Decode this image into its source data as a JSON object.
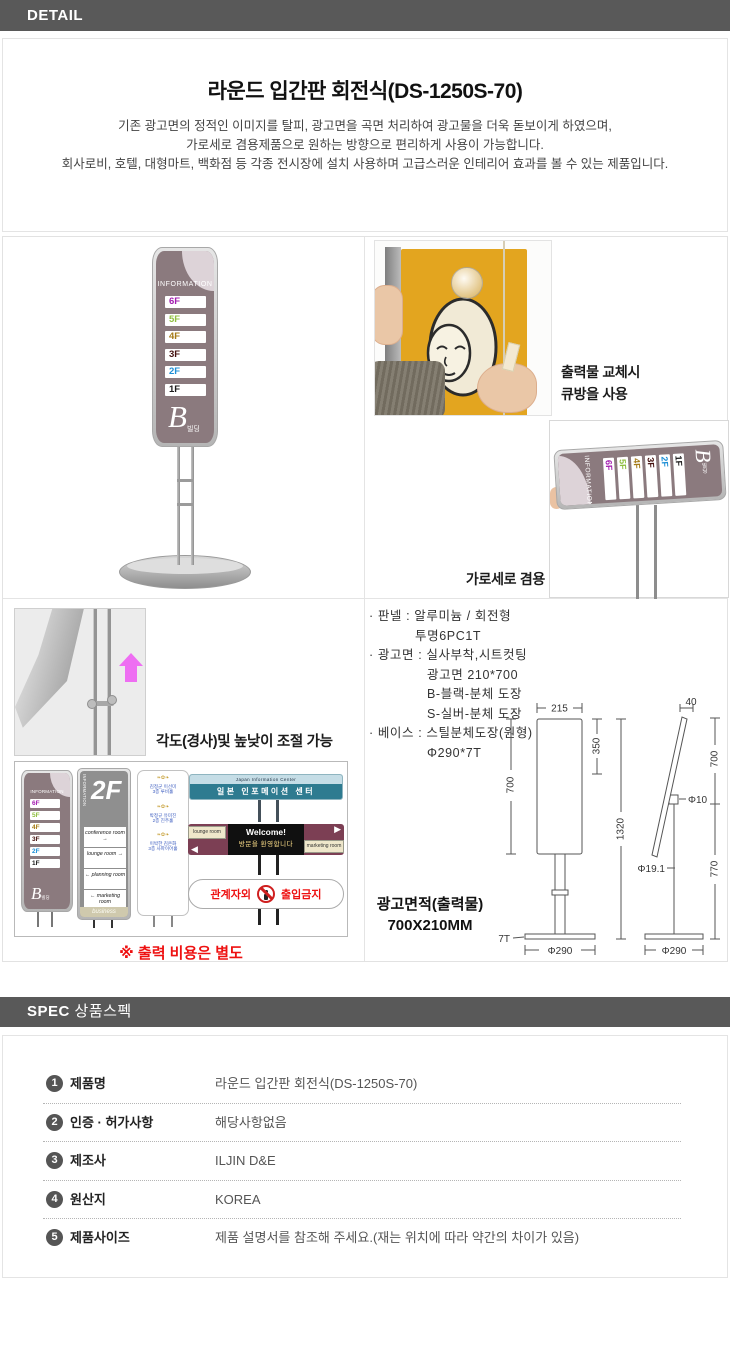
{
  "colors": {
    "header_bar": "#595959",
    "sign_body": "#8b7a7e",
    "sign_corner": "#ddd3d8",
    "teal": "#2e7b90",
    "maroon": "#7c3f54",
    "red_note": "#ee1111",
    "arrow_pink": "#ee6ef2",
    "poster_yellow": "#e3a51f"
  },
  "header": {
    "detail_label": "DETAIL"
  },
  "intro": {
    "title": "라운드 입간판 회전식(DS-1250S-70)",
    "desc1": "기존 광고면의 정적인 이미지를 탈피, 광고면을 곡면 처리하여 광고물을 더욱 돋보이게 하였으며,",
    "desc2": "가로세로 겸용제품으로 원하는 방향으로 편리하게 사용이 가능합니다.",
    "desc3": "회사로비, 호텔, 대형마트, 백화점 등 각종 전시장에 설치 사용하며 고급스러운 인테리어 효과를 볼 수 있는 제품입니다."
  },
  "sign": {
    "info_label": "INFORMATION",
    "floors": [
      {
        "label": "6F",
        "color": "#a21caf"
      },
      {
        "label": "5F",
        "color": "#8fbf3f"
      },
      {
        "label": "4F",
        "color": "#a57a16"
      },
      {
        "label": "3F",
        "color": "#44100e"
      },
      {
        "label": "2F",
        "color": "#1d8fd6"
      },
      {
        "label": "1F",
        "color": "#1a1a1a"
      }
    ],
    "building_big": "B",
    "building_small": "빌딩"
  },
  "usage": {
    "replace_line1": "출력물 교체시",
    "replace_line2": "큐방을 사용",
    "orientation_caption": "가로세로 겸용"
  },
  "adjust": {
    "caption": "각도(경사)및 높낮이 조절 가능",
    "print_cost_note": "※ 출력 비용은 별도"
  },
  "spec_text": {
    "lines": [
      "· 판넬 : 알루미늄 / 회전형",
      "투명6PC1T",
      "· 광고면 : 실사부착,시트컷팅",
      "광고면 210*700",
      "B-블랙-분체 도장",
      "S-실버-분체 도장",
      "· 베이스 : 스틸분체도장(원형)",
      "Φ290*7T"
    ],
    "ad_area1": "광고면적(출력물)",
    "ad_area2": "700X210MM"
  },
  "examples": {
    "sign2": {
      "info": "INFORMATION",
      "floor": "2F",
      "rows": [
        "conference room →",
        "lounge room →",
        "← planning room",
        "← marketing room"
      ],
      "footer": "business"
    },
    "sign3": {
      "ornament": "❧✿❧",
      "rows": [
        "김정군 이선미",
        "3층 루비홀",
        "박정규 유미진",
        "2층 진주홀",
        "이박한 김은화",
        "3층 사파이어홀"
      ]
    },
    "h1": {
      "top": "Japan  Information  Center",
      "main": "일본 인포메이션 센터"
    },
    "h2": {
      "left": "lounge room",
      "right": "marketing room",
      "center1": "Welcome!",
      "center2": "방문을 환영합니다",
      "arrow_left": "◀",
      "arrow_right": "▶"
    },
    "h3": {
      "left": "관계자외",
      "right": "출입금지"
    }
  },
  "diagram": {
    "front": {
      "width": "215",
      "upper": "350",
      "panel": "700",
      "total": "1320",
      "base_t": "7T",
      "base_d": "Φ290"
    },
    "side": {
      "top": "40",
      "upper": "700",
      "pivot": "Φ10",
      "pole": "Φ19.1",
      "lower": "770",
      "base_d": "Φ290"
    }
  },
  "spec": {
    "header_bold": "SPEC",
    "header_rest": "상품스펙",
    "rows": [
      {
        "num": "1",
        "label": "제품명",
        "value": "라운드 입간판 회전식(DS-1250S-70)"
      },
      {
        "num": "2",
        "label": "인증 · 허가사항",
        "value": "해당사항없음"
      },
      {
        "num": "3",
        "label": "제조사",
        "value": "ILJIN D&E"
      },
      {
        "num": "4",
        "label": "원산지",
        "value": "KOREA"
      },
      {
        "num": "5",
        "label": "제품사이즈",
        "value": "제품 설명서를 참조해 주세요.(재는 위치에 따라 약간의 차이가 있음)"
      }
    ]
  }
}
